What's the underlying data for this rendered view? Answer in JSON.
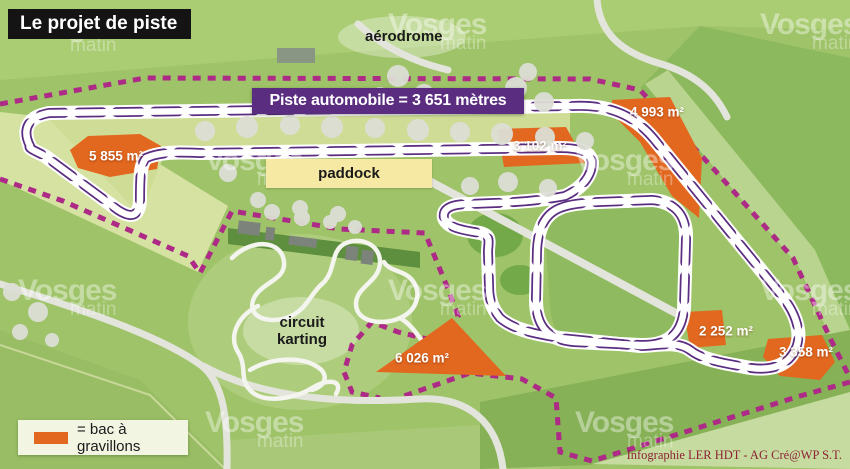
{
  "title": "Le projet de piste",
  "banner_text": "Piste automobile = 3 651 mètres",
  "labels": {
    "aerodrome": "aérodrome",
    "paddock": "paddock",
    "karting_line1": "circuit",
    "karting_line2": "karting"
  },
  "gravel_traps": [
    {
      "area": "5 855 m²"
    },
    {
      "area": "3 102 m²"
    },
    {
      "area": "4 993 m²"
    },
    {
      "area": "6 026 m²"
    },
    {
      "area": "2 252 m²"
    },
    {
      "area": "3 358 m²"
    }
  ],
  "legend": {
    "text": "= bac à gravillons",
    "swatch_color": "#e2671f"
  },
  "credit": "Infographie LER HDT - AG Cré@WP S.T.",
  "watermark": {
    "line1": "Vosges",
    "line2": "matin"
  },
  "colors": {
    "track_road": "#ffffff",
    "track_edge_line": "#5b2d80",
    "boundary_dashes": "#ad2a87",
    "gravel_trap": "#e2671f",
    "banner_bg": "#5b2d80",
    "base_green": "#9fc368"
  }
}
